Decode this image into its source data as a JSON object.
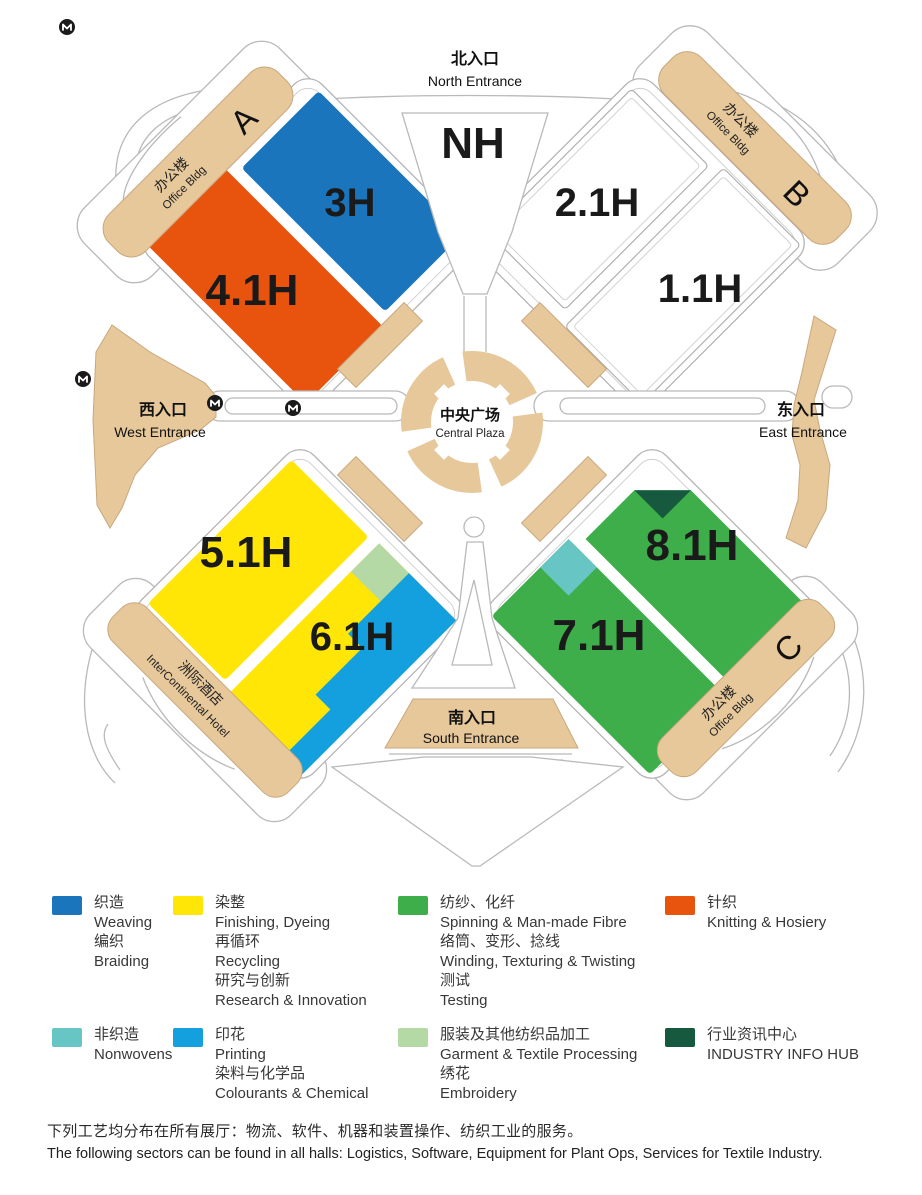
{
  "colors": {
    "weaving_blue": "#1B75BC",
    "finishing_yellow": "#FFE606",
    "spinning_green": "#3DAE49",
    "knitting_orange": "#E8540E",
    "nonwovens_teal": "#67C5C3",
    "printing_cyan": "#14A0DE",
    "garment_lightgreen": "#B5D9A4",
    "infohub_darkgreen": "#17593F",
    "plaza_tan": "#E7C89B",
    "hall11_label": "#9B9B9B"
  },
  "map": {
    "halls": {
      "nh": "NH",
      "h3": "3H",
      "h41": "4.1H",
      "h21": "2.1H",
      "h11": "1.1H",
      "h51": "5.1H",
      "h61": "6.1H",
      "h71": "7.1H",
      "h81": "8.1H"
    },
    "entrances": {
      "north": {
        "zh": "北入口",
        "en": "North Entrance"
      },
      "west": {
        "zh": "西入口",
        "en": "West Entrance"
      },
      "east": {
        "zh": "东入口",
        "en": "East Entrance"
      },
      "south": {
        "zh": "南入口",
        "en": "South Entrance"
      }
    },
    "plaza": {
      "zh": "中央广场",
      "en": "Central Plaza"
    },
    "buildings": {
      "a": {
        "zh": "办公楼",
        "en": "Office Bldg",
        "letter": "A"
      },
      "b": {
        "zh": "办公楼",
        "en": "Office Bldg",
        "letter": "B"
      },
      "c": {
        "zh": "办公楼",
        "en": "Office Bldg",
        "letter": "C"
      },
      "hotel": {
        "zh": "洲际酒店",
        "en": "InterContinental Hotel"
      }
    }
  },
  "legend": {
    "items": [
      {
        "name": "weaving",
        "color_key": "weaving_blue",
        "lines": [
          "织造",
          "Weaving",
          "编织",
          "Braiding"
        ]
      },
      {
        "name": "finishing",
        "color_key": "finishing_yellow",
        "lines": [
          "染整",
          "Finishing, Dyeing",
          "再循环",
          "Recycling",
          "研究与创新",
          "Research & Innovation"
        ]
      },
      {
        "name": "spinning",
        "color_key": "spinning_green",
        "lines": [
          "纺纱、化纤",
          "Spinning & Man-made Fibre",
          "络筒、变形、捻线",
          "Winding, Texturing & Twisting",
          "测试",
          "Testing"
        ]
      },
      {
        "name": "knitting",
        "color_key": "knitting_orange",
        "lines": [
          "针织",
          "Knitting & Hosiery"
        ]
      },
      {
        "name": "nonwovens",
        "color_key": "nonwovens_teal",
        "lines": [
          "非织造",
          "Nonwovens"
        ]
      },
      {
        "name": "printing",
        "color_key": "printing_cyan",
        "lines": [
          "印花",
          "Printing",
          "染料与化学品",
          "Colourants & Chemical"
        ]
      },
      {
        "name": "garment",
        "color_key": "garment_lightgreen",
        "lines": [
          "服装及其他纺织品加工",
          "Garment & Textile Processing",
          "绣花",
          "Embroidery"
        ]
      },
      {
        "name": "infohub",
        "color_key": "infohub_darkgreen",
        "lines": [
          "行业资讯中心",
          "INDUSTRY INFO HUB"
        ]
      }
    ]
  },
  "footnote": {
    "zh": "下列工艺均分布在所有展厅：物流、软件、机器和装置操作、纺织工业的服务。",
    "en": "The following sectors can be found in all halls: Logistics, Software, Equipment for Plant Ops, Services for Textile Industry."
  }
}
